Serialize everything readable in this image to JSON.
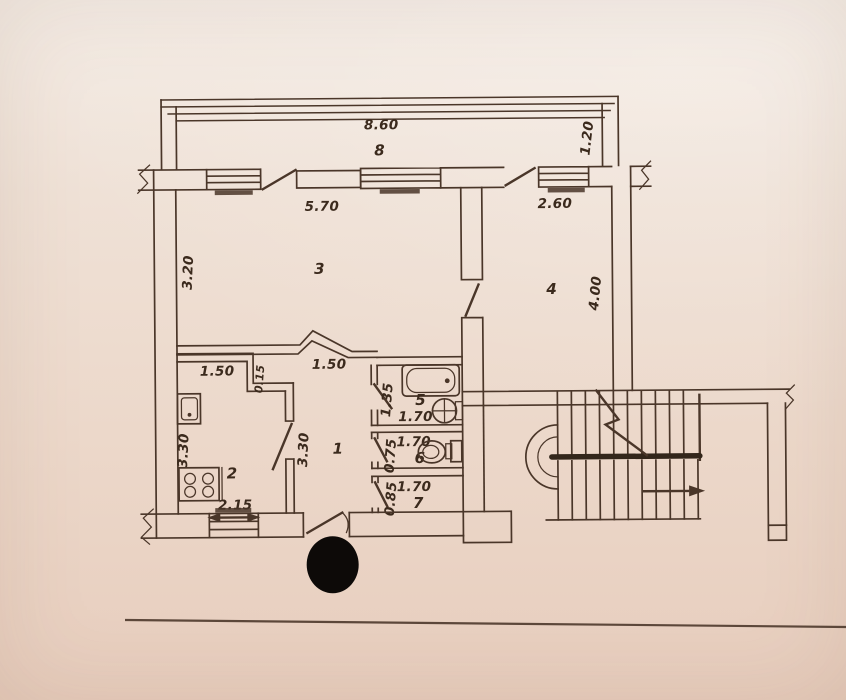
{
  "theme": {
    "paper-top": "#f4ece5",
    "paper-mid": "#ecd8ca",
    "paper-bottom": "#e7cdbd",
    "ink": "#4a3629",
    "ink-strong": "#33261b",
    "text-ink": "#3b2a1d",
    "line-soft": "#5c473a",
    "dot": "#0d0a08"
  },
  "plan": {
    "rooms": {
      "hall": {
        "number": "1",
        "width": "1.50",
        "depth": "3.30"
      },
      "kitchen": {
        "number": "2",
        "width": "1.50",
        "wall_stub": "0.15",
        "depth": "3.30",
        "window_width": "2.15"
      },
      "living": {
        "number": "3",
        "width": "5.70",
        "depth": "3.20"
      },
      "room4": {
        "number": "4",
        "width": "2.60",
        "depth": "4.00"
      },
      "bath": {
        "number": "5",
        "depth": "1.35",
        "width": "1.70"
      },
      "wc": {
        "number": "6",
        "depth": "0.75",
        "width": "1.70"
      },
      "pantry": {
        "number": "7",
        "depth": "0.85",
        "width": "1.70"
      },
      "balcony": {
        "number": "8",
        "length": "8.60",
        "depth": "1.20"
      }
    }
  }
}
